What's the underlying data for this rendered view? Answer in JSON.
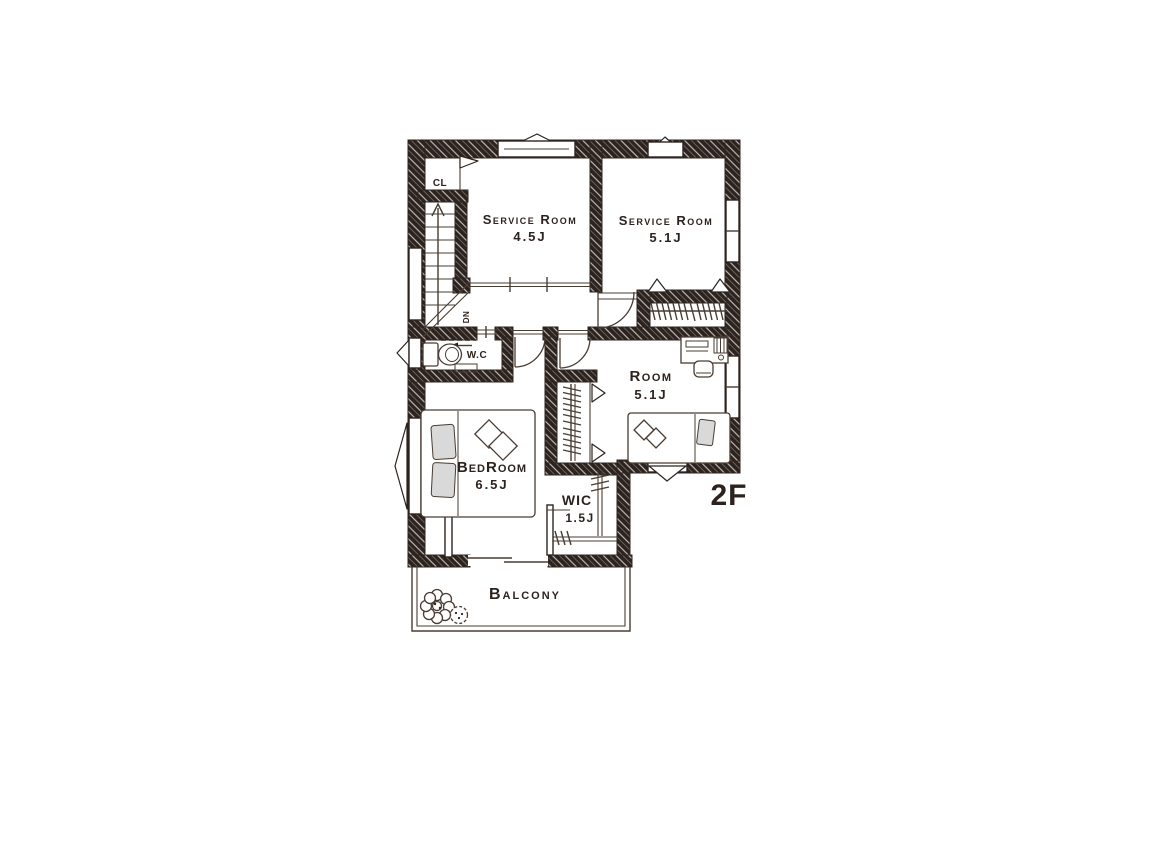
{
  "title": "2F Floor Plan",
  "floor_label": "2F",
  "colors": {
    "ink": "#2d231e",
    "line": "#4a3c33",
    "pillow_gray": "#d9d9d9",
    "background": "#ffffff"
  },
  "rooms": {
    "closet": {
      "label": "CL"
    },
    "service_room_a": {
      "name": "Service Room",
      "size": "4.5J"
    },
    "service_room_b": {
      "name": "Service Room",
      "size": "5.1J"
    },
    "room": {
      "name": "Room",
      "size": "5.1J"
    },
    "bedroom": {
      "name": "BedRoom",
      "size": "6.5J"
    },
    "wic": {
      "name": "WIC",
      "size": "1.5J"
    },
    "wc": {
      "label": "W.C"
    },
    "balcony": {
      "name": "Balcony"
    }
  },
  "stairs": {
    "direction_label": "DN"
  }
}
